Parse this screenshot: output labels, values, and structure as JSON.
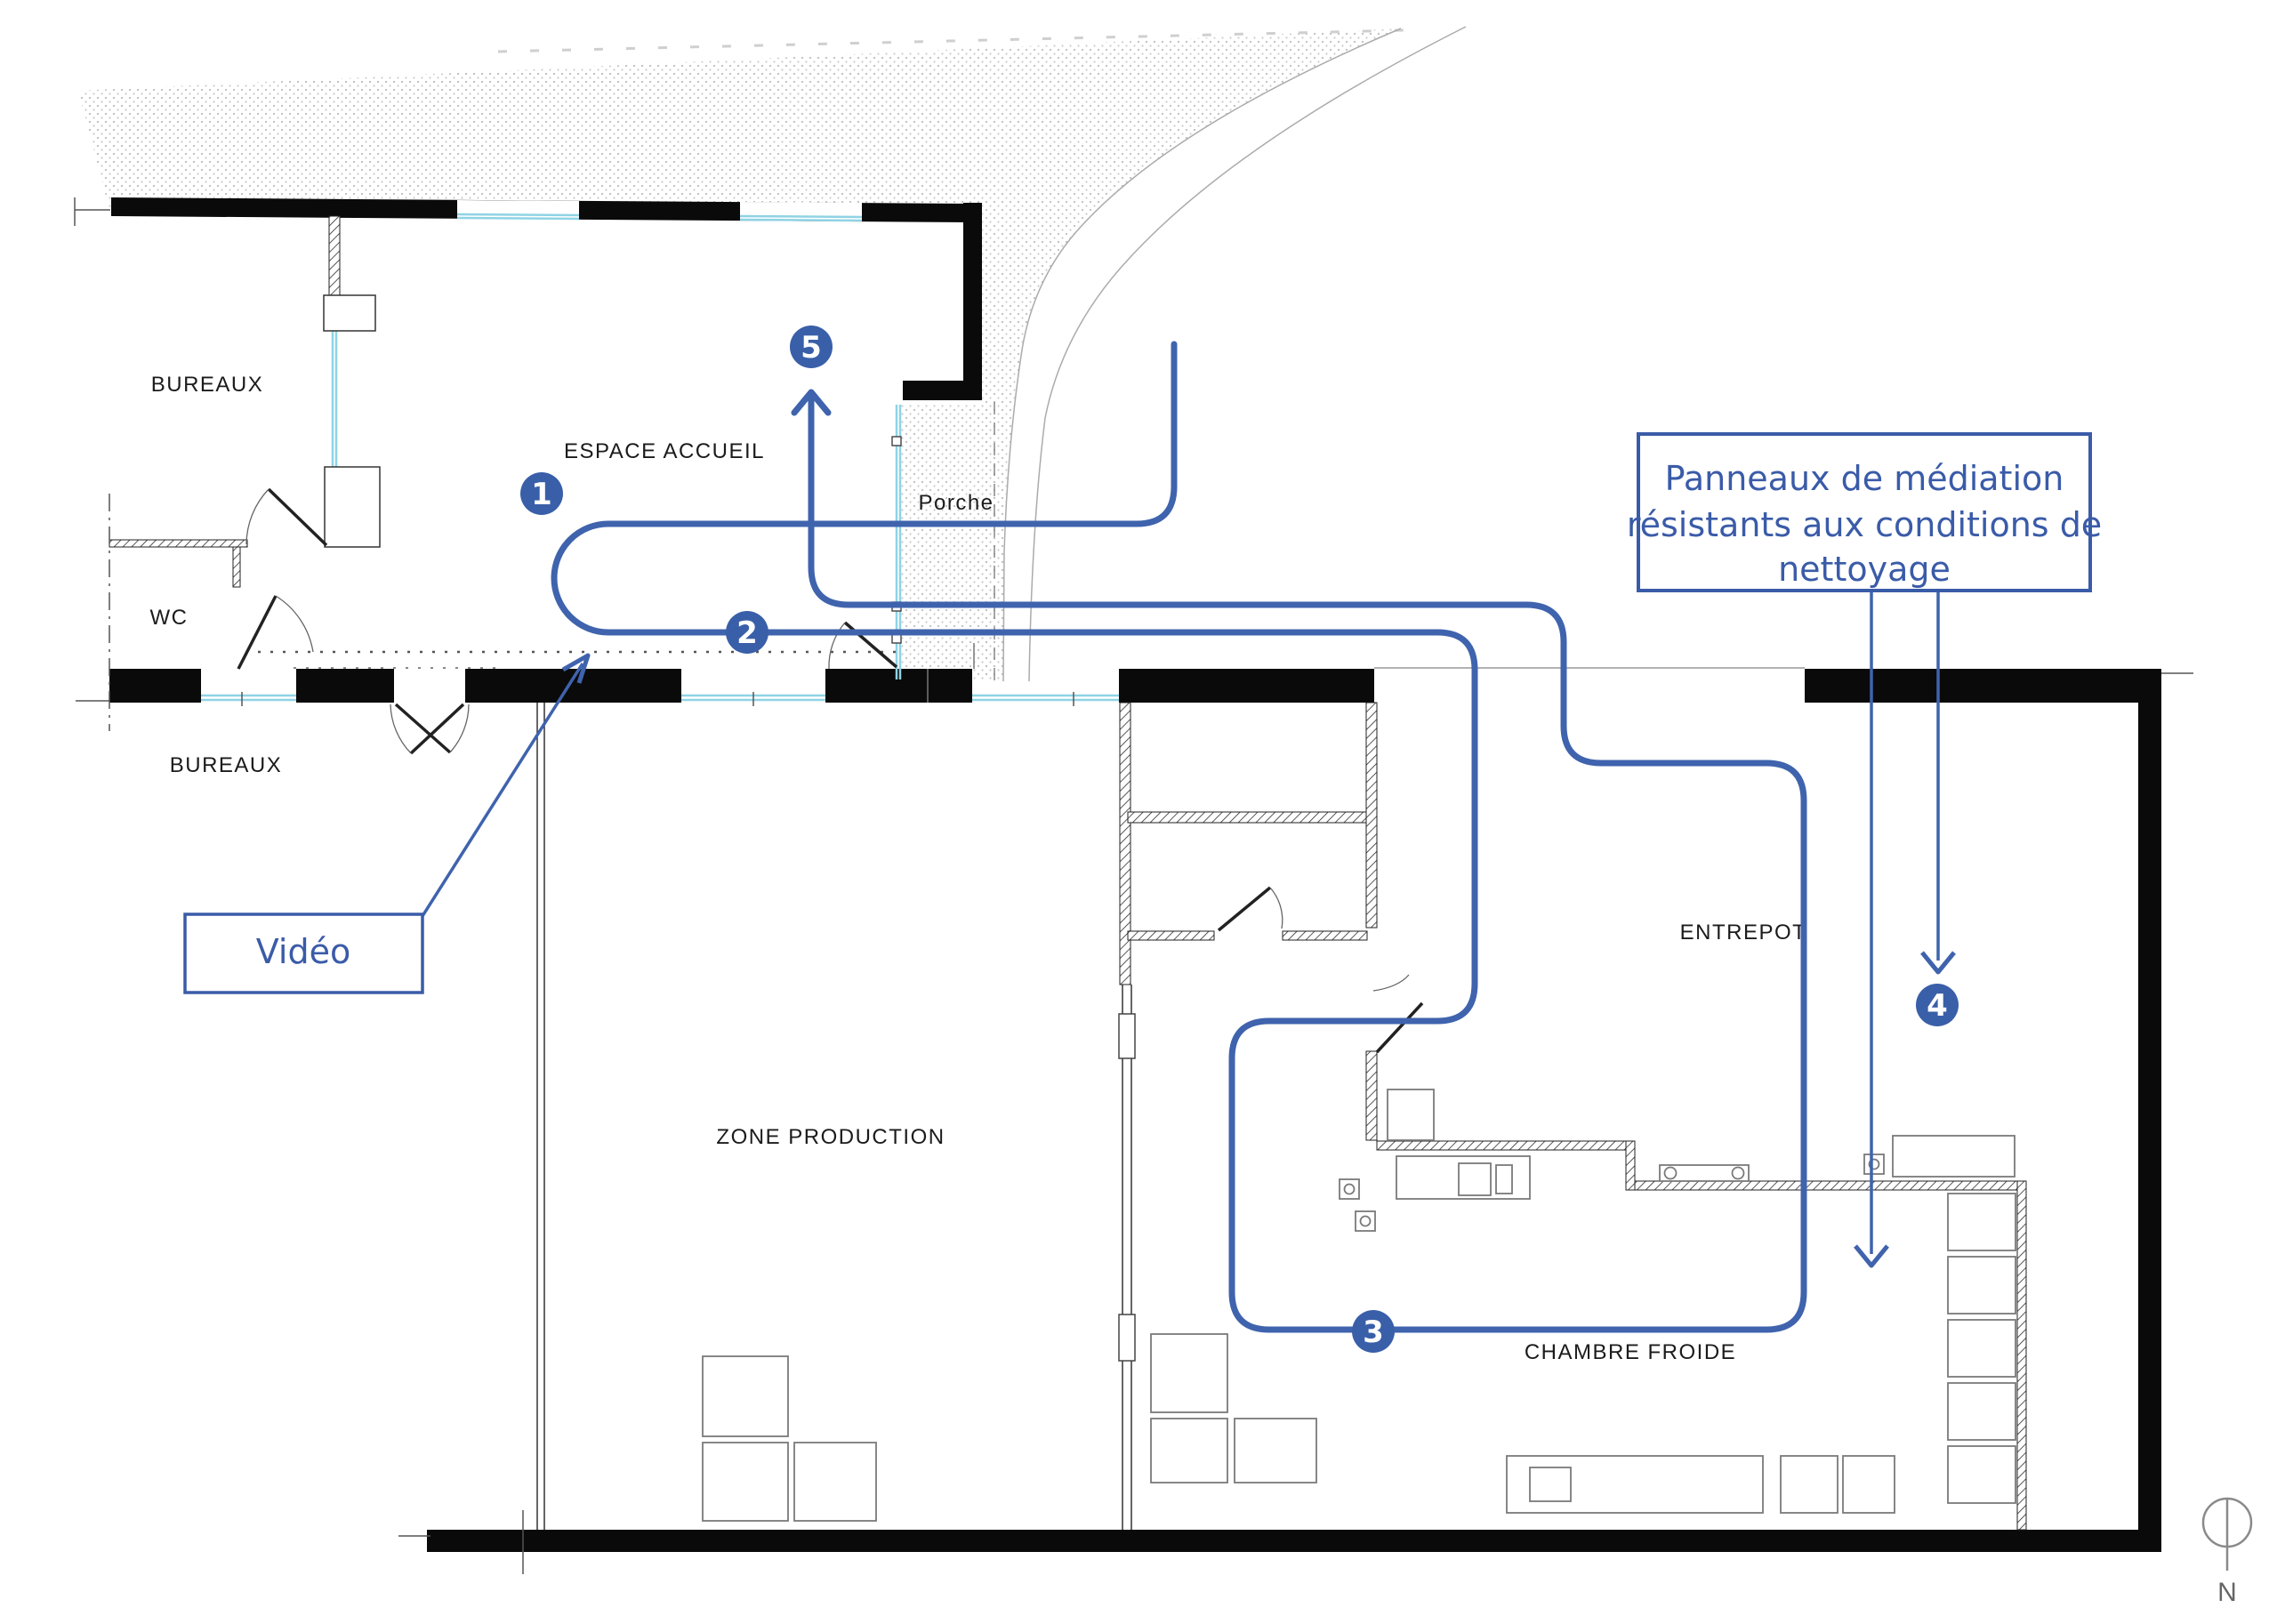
{
  "floor_plan": {
    "rooms": [
      {
        "id": "bureaux_top",
        "label": "BUREAUX"
      },
      {
        "id": "espace_accueil",
        "label": "ESPACE ACCUEIL"
      },
      {
        "id": "porche",
        "label": "Porche"
      },
      {
        "id": "wc",
        "label": "WC"
      },
      {
        "id": "bureaux_bottom",
        "label": "BUREAUX"
      },
      {
        "id": "zone_production",
        "label": "ZONE PRODUCTION"
      },
      {
        "id": "entrepot",
        "label": "ENTREPOT"
      },
      {
        "id": "chambre_froide",
        "label": "CHAMBRE FROIDE"
      }
    ],
    "route_markers": [
      {
        "number": "1"
      },
      {
        "number": "2"
      },
      {
        "number": "3"
      },
      {
        "number": "4"
      },
      {
        "number": "5"
      }
    ],
    "annotations": {
      "video": {
        "label": "Vidéo"
      },
      "panneaux": {
        "lines": [
          "Panneaux de médiation",
          "résistants aux conditions de",
          "nettoyage"
        ]
      }
    },
    "compass": {
      "label": "N"
    },
    "colors": {
      "route_blue": "#3f63ad",
      "marker_blue": "#3a5fa9",
      "annotation_blue": "#3a5ba8",
      "glazing_cyan": "#8fd3e4",
      "wall_black": "#0a0a0a"
    }
  }
}
